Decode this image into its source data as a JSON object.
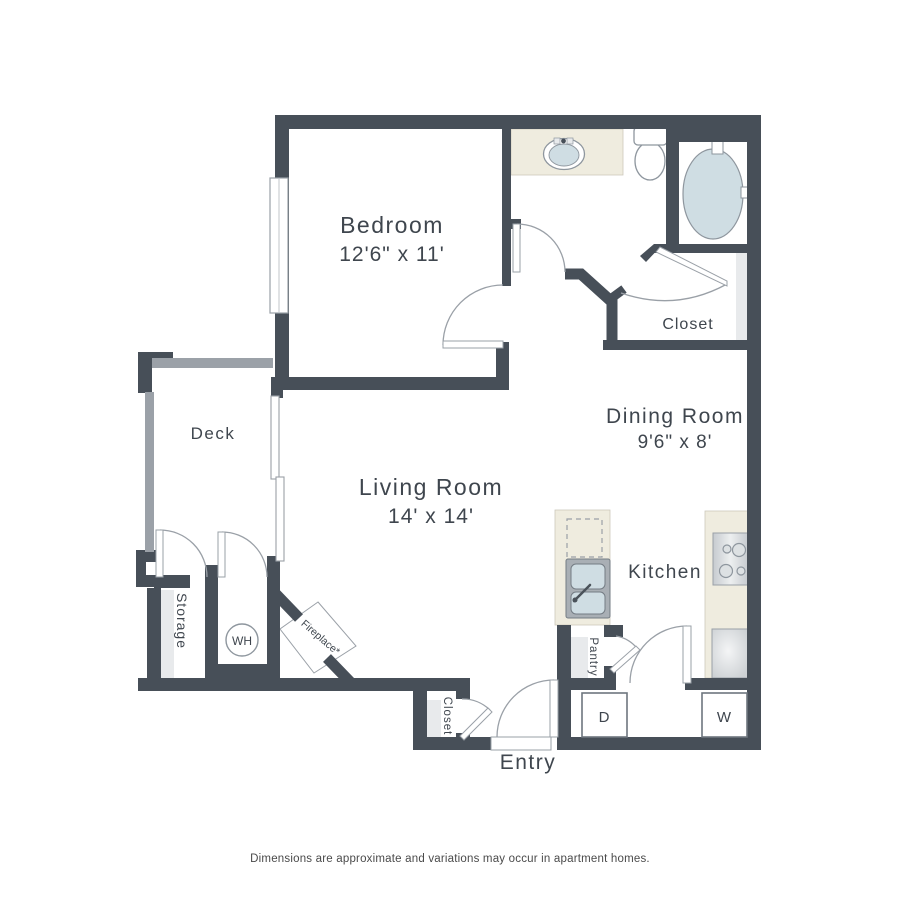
{
  "rooms": {
    "bedroom": {
      "name": "Bedroom",
      "dims": "12'6\" x 11'"
    },
    "living_room": {
      "name": "Living Room",
      "dims": "14' x 14'"
    },
    "dining_room": {
      "name": "Dining Room",
      "dims": "9'6\" x 8'"
    },
    "kitchen": {
      "name": "Kitchen"
    },
    "deck": {
      "name": "Deck"
    },
    "storage": {
      "name": "Storage"
    },
    "pantry": {
      "name": "Pantry"
    },
    "hall_closet": {
      "name": "Closet"
    },
    "entry_closet": {
      "name": "Closet"
    },
    "entry": {
      "name": "Entry"
    }
  },
  "appliances": {
    "water_heater": "WH",
    "dryer": "D",
    "washer": "W",
    "fireplace": "Fireplace*"
  },
  "footer": {
    "disclaimer": "Dimensions are approximate and variations may occur in apartment homes."
  },
  "colors": {
    "wall": "#474F58",
    "railing": "#9BA1A8",
    "counter": "#EFECDF",
    "fixture_blue": "#CFDDE3",
    "shelf_gray": "#E8EAEC"
  }
}
